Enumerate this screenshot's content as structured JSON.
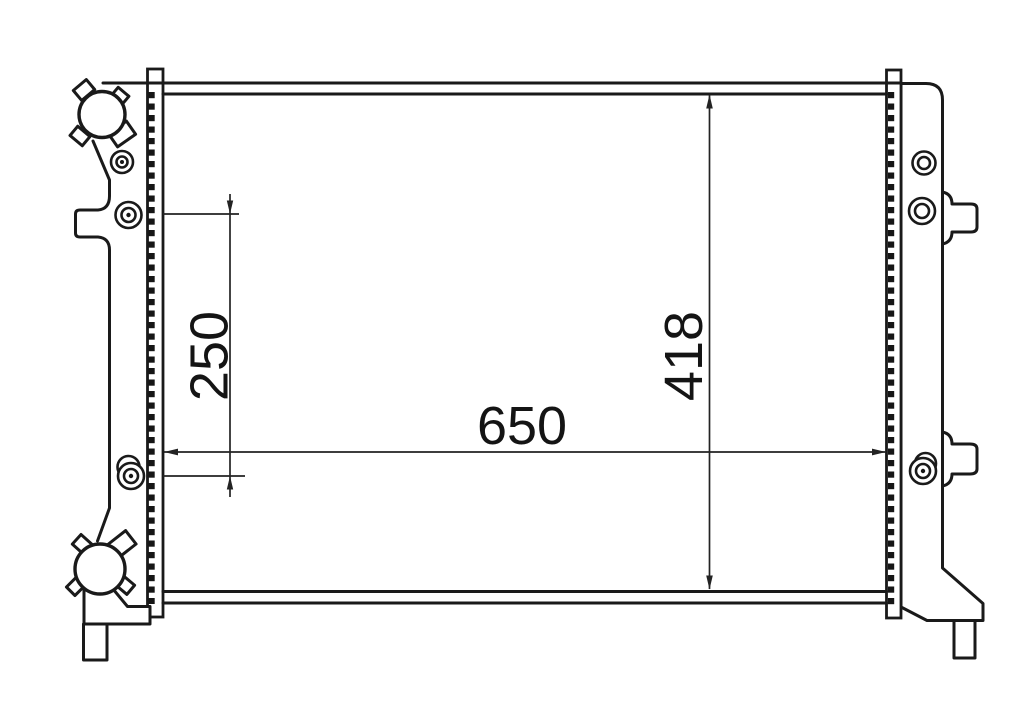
{
  "diagram": {
    "kind": "radiator-engineering-line-drawing",
    "line_color": "#1a1a1a",
    "background": "#ffffff",
    "dimensions": {
      "width": "650",
      "height": "418",
      "offset": "250"
    }
  }
}
